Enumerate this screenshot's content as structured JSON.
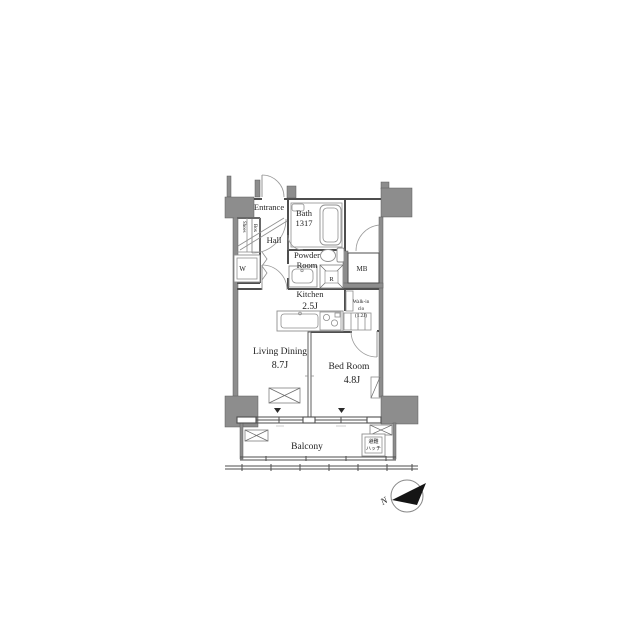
{
  "colors": {
    "wall": "#8d8d8d",
    "wallstroke": "#5a5a5a",
    "line": "#4e4e4e",
    "fixture": "#8f8f8f",
    "text": "#1f1f1f"
  },
  "plan": {
    "entrance": {
      "label": "Entrance"
    },
    "shoes_box": {
      "line1": "Shoes",
      "line2": "Box"
    },
    "washer": {
      "label": "W"
    },
    "hall": {
      "label": "Hall"
    },
    "bath": {
      "name": "Bath",
      "size": "1317"
    },
    "powder_room": {
      "line1": "Powder",
      "line2": "Room"
    },
    "meter_box": {
      "label": "MB"
    },
    "refrigerator": {
      "label": "R"
    },
    "kitchen": {
      "name": "Kitchen",
      "size": "2.5J"
    },
    "walk_in_closet": {
      "line1": "Walk-in",
      "line2": "clo",
      "line3": "(1.2J)"
    },
    "living_dining": {
      "name": "Living Dining",
      "size": "8.7J"
    },
    "bed_room": {
      "name": "Bed Room",
      "size": "4.8J"
    },
    "balcony": {
      "label": "Balcony"
    },
    "evacuation_hatch": {
      "line1": "避難",
      "line2": "ハッチ"
    },
    "compass": {
      "label": "N"
    }
  }
}
